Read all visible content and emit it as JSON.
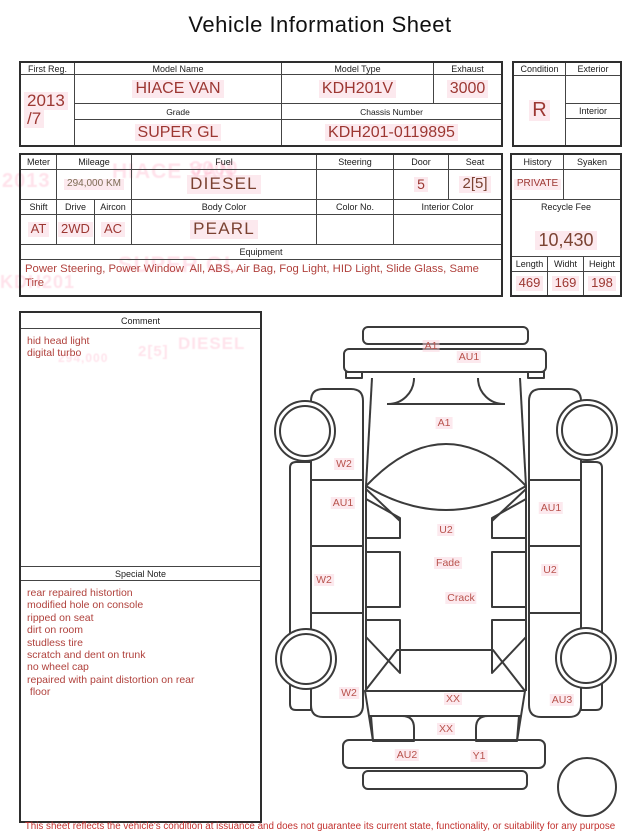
{
  "title": "Vehicle Information Sheet",
  "table1": {
    "first_reg": {
      "label": "First Reg.",
      "line1": "2013",
      "line2": "/7"
    },
    "model_name": {
      "label": "Model Name",
      "value": "HIACE VAN"
    },
    "model_type": {
      "label": "Model Type",
      "value": "KDH201V"
    },
    "exhaust": {
      "label": "Exhaust",
      "value": "3000"
    },
    "grade": {
      "label": "Grade",
      "value": "SUPER GL"
    },
    "chassis_number": {
      "label": "Chassis Number",
      "value": "KDH201-0119895"
    },
    "condition": {
      "label": "Condition",
      "value": "R"
    },
    "exterior": {
      "label": "Exterior",
      "value": ""
    },
    "interior": {
      "label": "Interior",
      "value": ""
    }
  },
  "table2": {
    "meter": {
      "label": "Meter",
      "value": ""
    },
    "mileage": {
      "label": "Mileage",
      "value": "294,000 KM"
    },
    "fuel": {
      "label": "Fuel",
      "value": "DIESEL"
    },
    "steering": {
      "label": "Steering",
      "value": ""
    },
    "door": {
      "label": "Door",
      "value": "5"
    },
    "seat": {
      "label": "Seat",
      "value": "2[5]"
    },
    "shift": {
      "label": "Shift",
      "value": "AT"
    },
    "drive": {
      "label": "Drive",
      "value": "2WD"
    },
    "aircon": {
      "label": "Aircon",
      "value": "AC"
    },
    "body_color": {
      "label": "Body Color",
      "value": "PEARL"
    },
    "color_no": {
      "label": "Color No.",
      "value": ""
    },
    "interior_color": {
      "label": "Interior Color",
      "value": ""
    },
    "equipment": {
      "label": "Equipment",
      "value": "Power Steering, Power Window  All, ABS, Air Bag, Fog Light, HID Light, Slide Glass, Same Tire"
    },
    "history": {
      "label": "History",
      "value": "PRIVATE"
    },
    "syaken": {
      "label": "Syaken",
      "value": ""
    },
    "recycle_fee": {
      "label": "Recycle Fee",
      "value": "10,430"
    },
    "length": {
      "label": "Length",
      "value": "469"
    },
    "width": {
      "label": "Widht",
      "value": "169"
    },
    "height": {
      "label": "Height",
      "value": "198"
    }
  },
  "comment": {
    "label": "Comment",
    "lines": [
      "hid head light",
      "digital turbo"
    ]
  },
  "special_note": {
    "label": "Special Note",
    "lines": [
      "rear repaired histortion",
      "modified hole on console",
      "ripped on seat",
      "dirt on room",
      "studless tire",
      "scratch and dent on trunk",
      "no wheel cap",
      "repaired with paint distortion on rear",
      " floor"
    ]
  },
  "diagram_marks": [
    {
      "label": "A1",
      "x": 431,
      "y": 346
    },
    {
      "label": "AU1",
      "x": 469,
      "y": 357
    },
    {
      "label": "A1",
      "x": 444,
      "y": 423
    },
    {
      "label": "W2",
      "x": 344,
      "y": 464
    },
    {
      "label": "AU1",
      "x": 343,
      "y": 503
    },
    {
      "label": "AU1",
      "x": 551,
      "y": 508
    },
    {
      "label": "U2",
      "x": 446,
      "y": 530
    },
    {
      "label": "Fade",
      "x": 448,
      "y": 563
    },
    {
      "label": "W2",
      "x": 324,
      "y": 580
    },
    {
      "label": "U2",
      "x": 550,
      "y": 570
    },
    {
      "label": "Crack",
      "x": 461,
      "y": 598
    },
    {
      "label": "W2",
      "x": 349,
      "y": 693
    },
    {
      "label": "XX",
      "x": 453,
      "y": 699
    },
    {
      "label": "AU3",
      "x": 562,
      "y": 700
    },
    {
      "label": "XX",
      "x": 446,
      "y": 729
    },
    {
      "label": "AU2",
      "x": 407,
      "y": 755
    },
    {
      "label": "Y1",
      "x": 479,
      "y": 756
    }
  ],
  "ghost_texts": [
    {
      "text": "HIACE VAN",
      "x": 112,
      "y": 160,
      "size": 21
    },
    {
      "text": "3000",
      "x": 190,
      "y": 158,
      "size": 20
    },
    {
      "text": "2013",
      "x": 2,
      "y": 170,
      "size": 20
    },
    {
      "text": "SUPER GL",
      "x": 118,
      "y": 252,
      "size": 22
    },
    {
      "text": "KDH201",
      "x": 0,
      "y": 272,
      "size": 18
    },
    {
      "text": "DIESEL",
      "x": 178,
      "y": 334,
      "size": 17
    },
    {
      "text": "2[5]",
      "x": 138,
      "y": 343,
      "size": 15
    },
    {
      "text": "294,000",
      "x": 58,
      "y": 351,
      "size": 12
    }
  ],
  "footer": {
    "disclaimer": "This sheet reflects the vehicle's condition at issuance and does not guarantee its current state, functionality, or suitability for any purpose"
  },
  "colors": {
    "value_red": "#9c3732",
    "dark_maroon": "#7b4232",
    "mileage_brown": "#7d6b54",
    "mark_red": "#b8524c",
    "disclaimer_red": "#c2312e",
    "line_dark": "#3b3b3b",
    "ghost_pink": "#ff9ab8"
  }
}
